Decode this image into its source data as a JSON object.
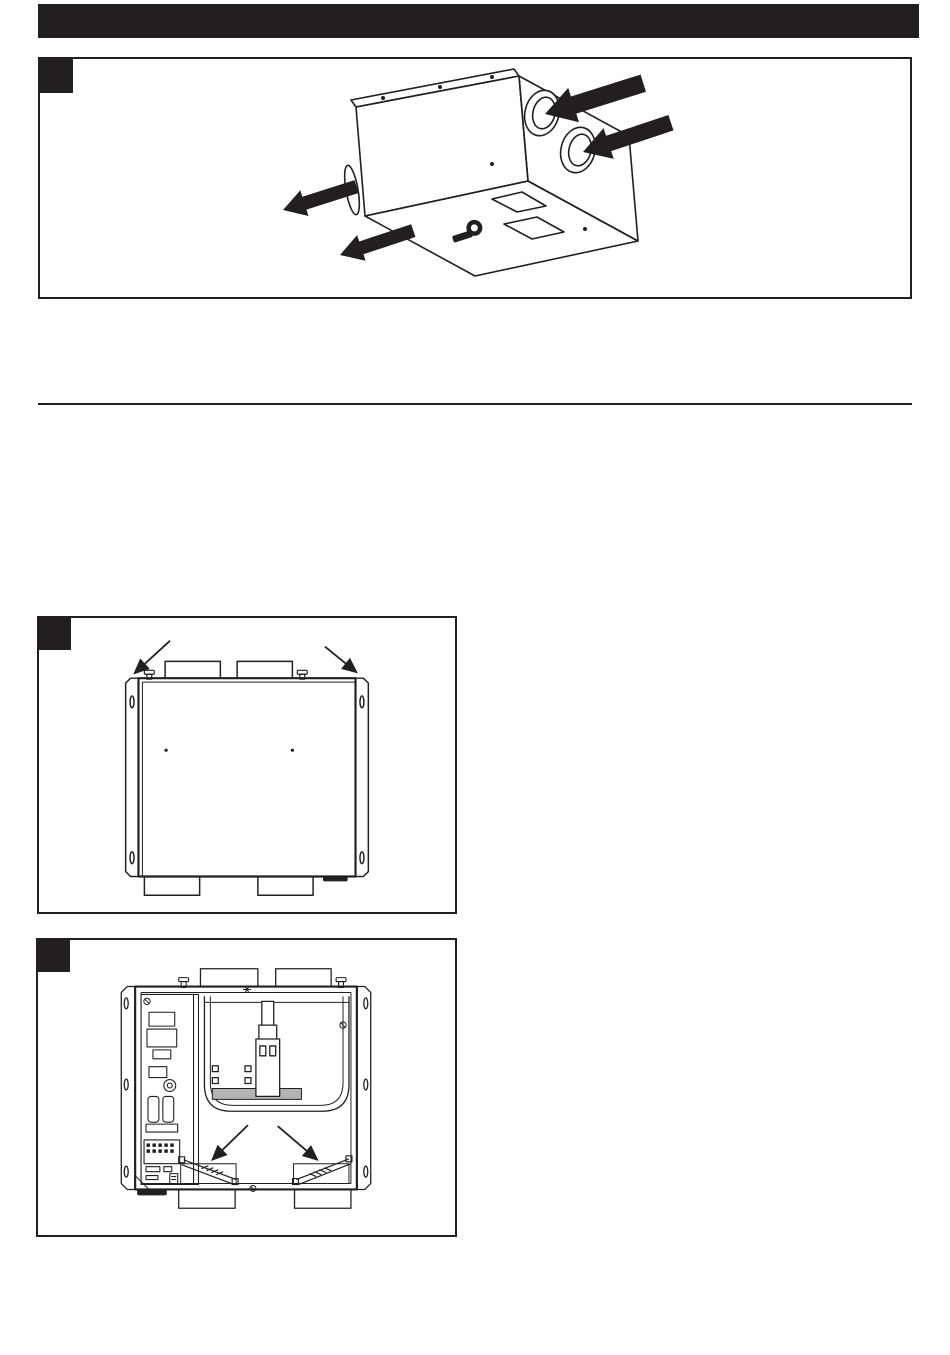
{
  "page": {
    "width": 950,
    "height": 1355,
    "background_color": "#ffffff",
    "ink_color": "#231f20"
  },
  "header": {
    "title": "",
    "bar_color": "#231f20"
  },
  "figures": [
    {
      "id": "figure-1",
      "step_label": "",
      "name": "isometric-view-of-ventilation-unit-with-airflow-arrows",
      "icons": [
        "airflow-in-arrow",
        "airflow-in-arrow",
        "airflow-out-arrow",
        "airflow-out-arrow",
        "brand-logo"
      ]
    },
    {
      "id": "figure-2",
      "step_label": "",
      "name": "front-view-closed-unit-with-mounting-flange-arrows",
      "icons": [
        "pointer-arrow",
        "pointer-arrow"
      ]
    },
    {
      "id": "figure-3",
      "step_label": "",
      "name": "front-view-open-unit-internals-with-filter-arrows",
      "icons": [
        "pointer-arrow",
        "pointer-arrow"
      ]
    }
  ]
}
